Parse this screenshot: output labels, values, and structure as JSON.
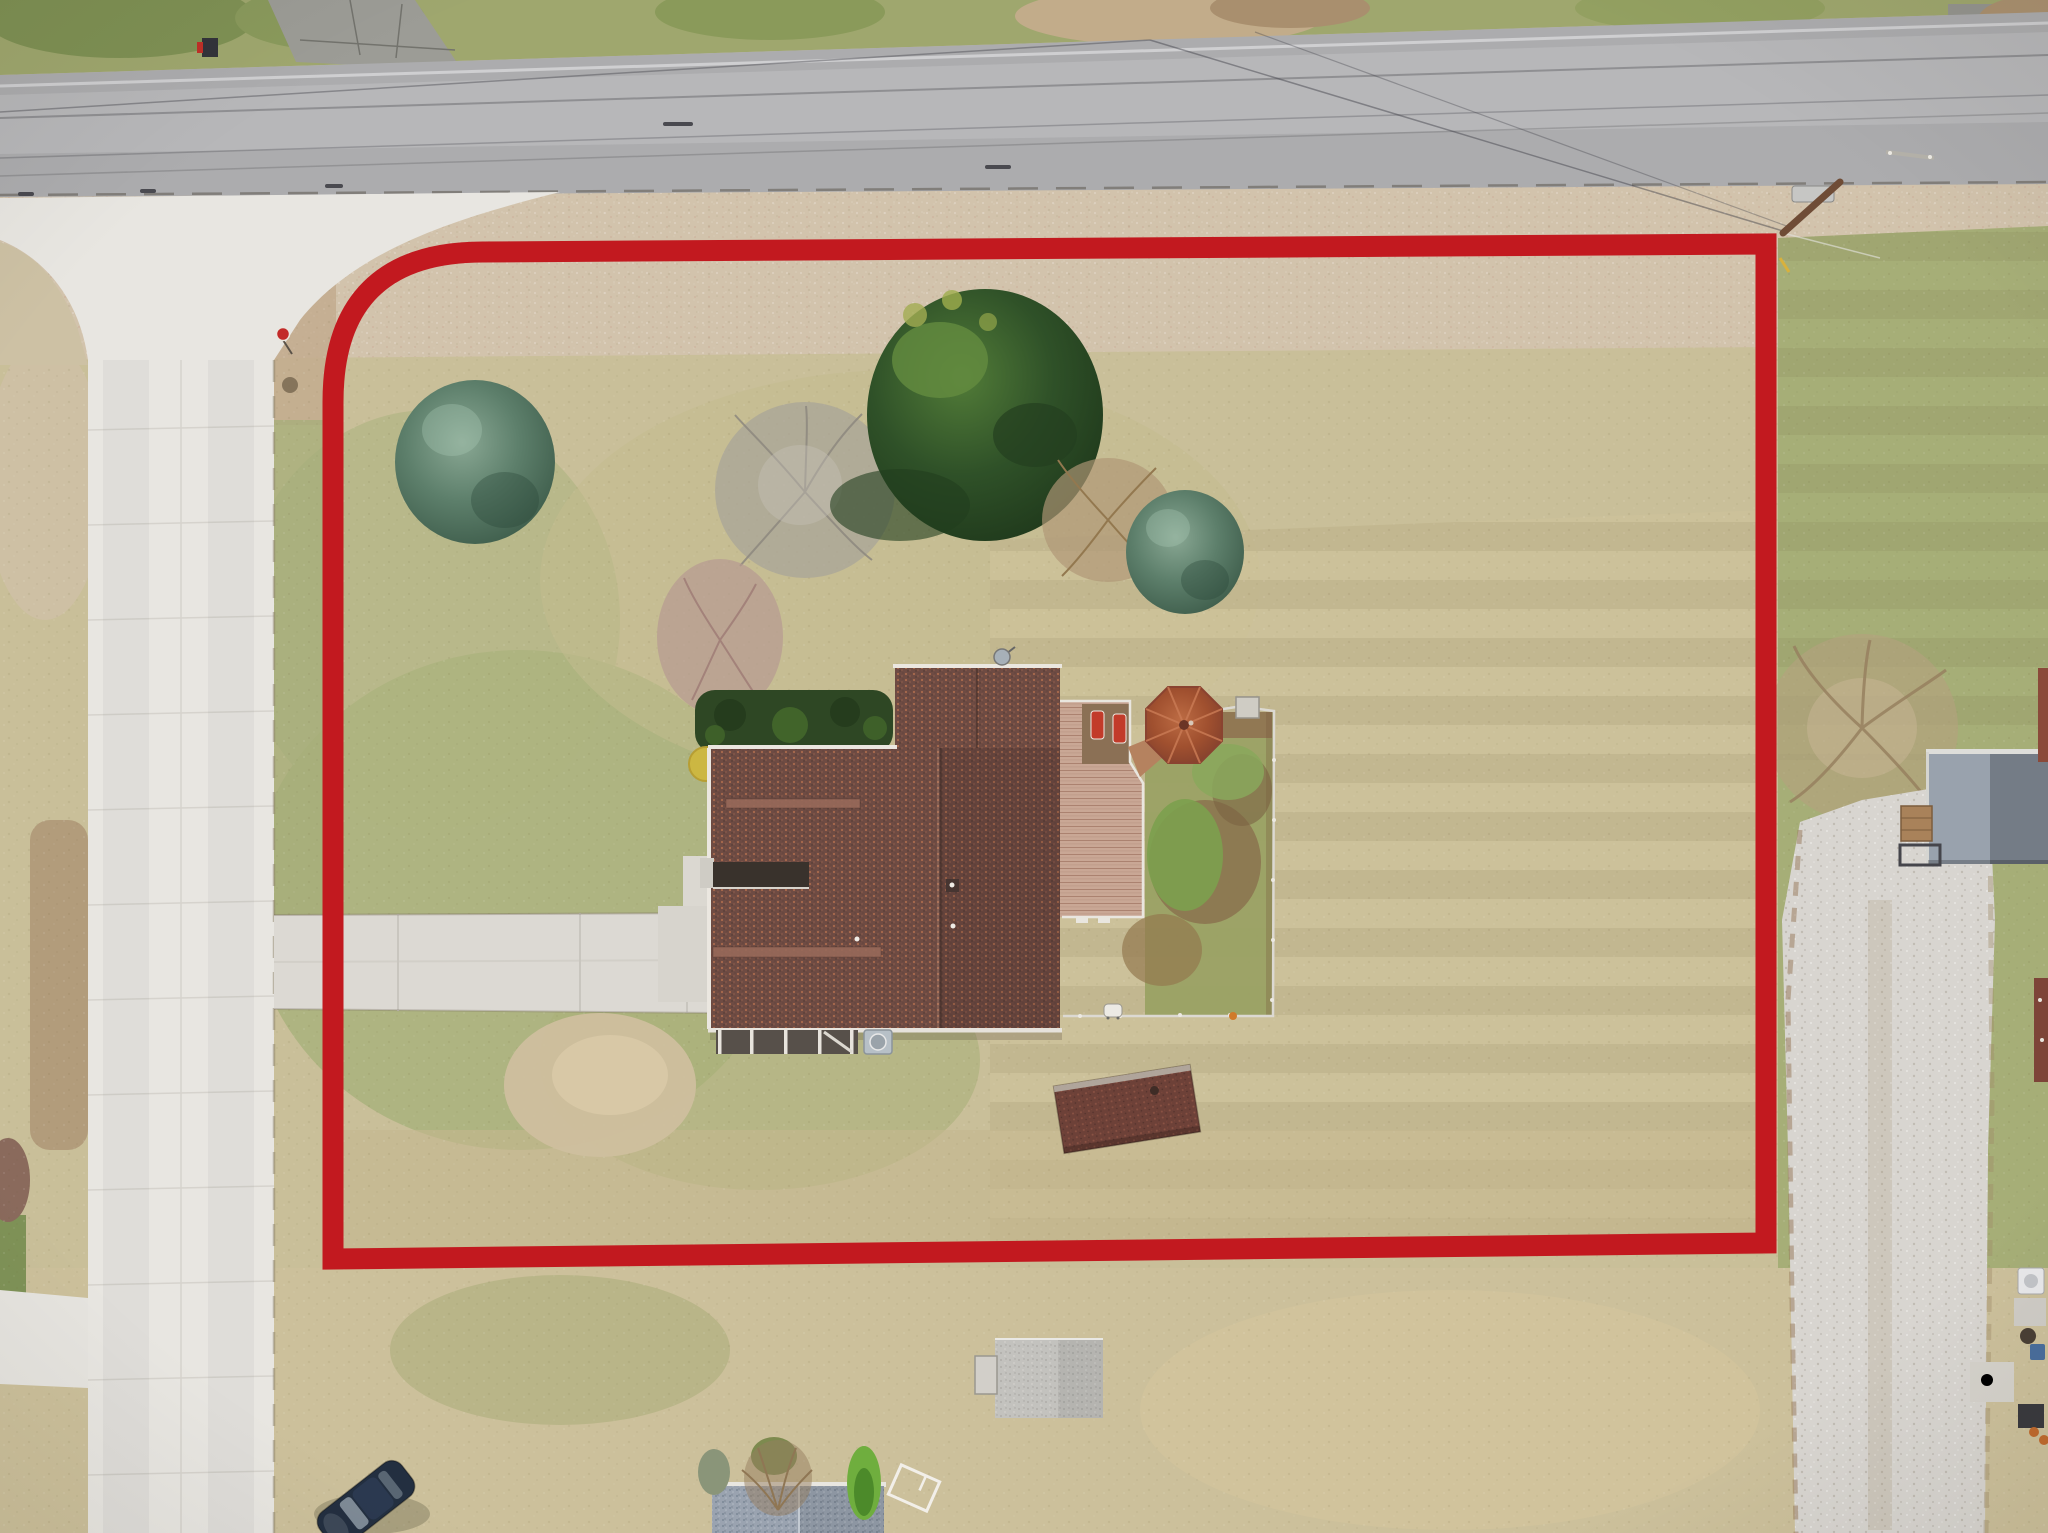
{
  "scene": {
    "kind": "aerial-drone-photograph",
    "subject": "single-family home on large lot outlined with red property-boundary overlay",
    "season": "late fall / dormant grass",
    "orientation": "top-down (nadir) view"
  },
  "palette": {
    "boundary_red": "#c2191f",
    "asphalt_road": "#adadaf",
    "concrete_street": "#e8e6e1",
    "lot_grass_olive": "#c6bd92",
    "lot_grass_green": "#a9b17c",
    "dry_grass_pink": "#d2c3ac",
    "house_shingle_brown": "#6e4b43",
    "deck_wood": "#c9a795",
    "gazebo_rust": "#a0502f",
    "shed_maroon": "#6d4138",
    "gray_shed": "#c3c2be",
    "blue_roof": "#9aa3b0",
    "gravel": "#d8d5d0",
    "evergreen_dark": "#2f5128",
    "spruce_teal": "#5d7f6b"
  },
  "boundary": {
    "shape": "rectangle with rounded top-left corner",
    "stroke_px": 21,
    "color": "#c2191f"
  },
  "objects": [
    "main-road-top",
    "side-street-left",
    "intersection-apron",
    "neighbor-driveway-stub",
    "mailbox",
    "stop-sign",
    "manhole-dot",
    "power-lines",
    "utility-pole",
    "property-boundary",
    "blue-spruce-left",
    "gray-bare-tree",
    "large-evergreen",
    "brown-bare-tree",
    "blue-spruce-right",
    "mauve-shrub",
    "hedge-row",
    "yellow-bush",
    "house-roof",
    "porch-carport",
    "ac-unit",
    "satellite-dish",
    "chimney",
    "driveway",
    "concrete-pads",
    "dirt-patch",
    "wood-deck",
    "lounge-chairs",
    "gazebo",
    "garden-fence",
    "fenced-garden",
    "grill",
    "red-shed",
    "bare-tree-right",
    "gravel-driveway",
    "gray-blue-building",
    "wood-crate",
    "trailer-frame",
    "gray-shed-bottom",
    "second-house-roof",
    "bushes-cluster",
    "trampoline-frame",
    "parked-car",
    "roadside-culvert",
    "right-edge-clutter"
  ]
}
